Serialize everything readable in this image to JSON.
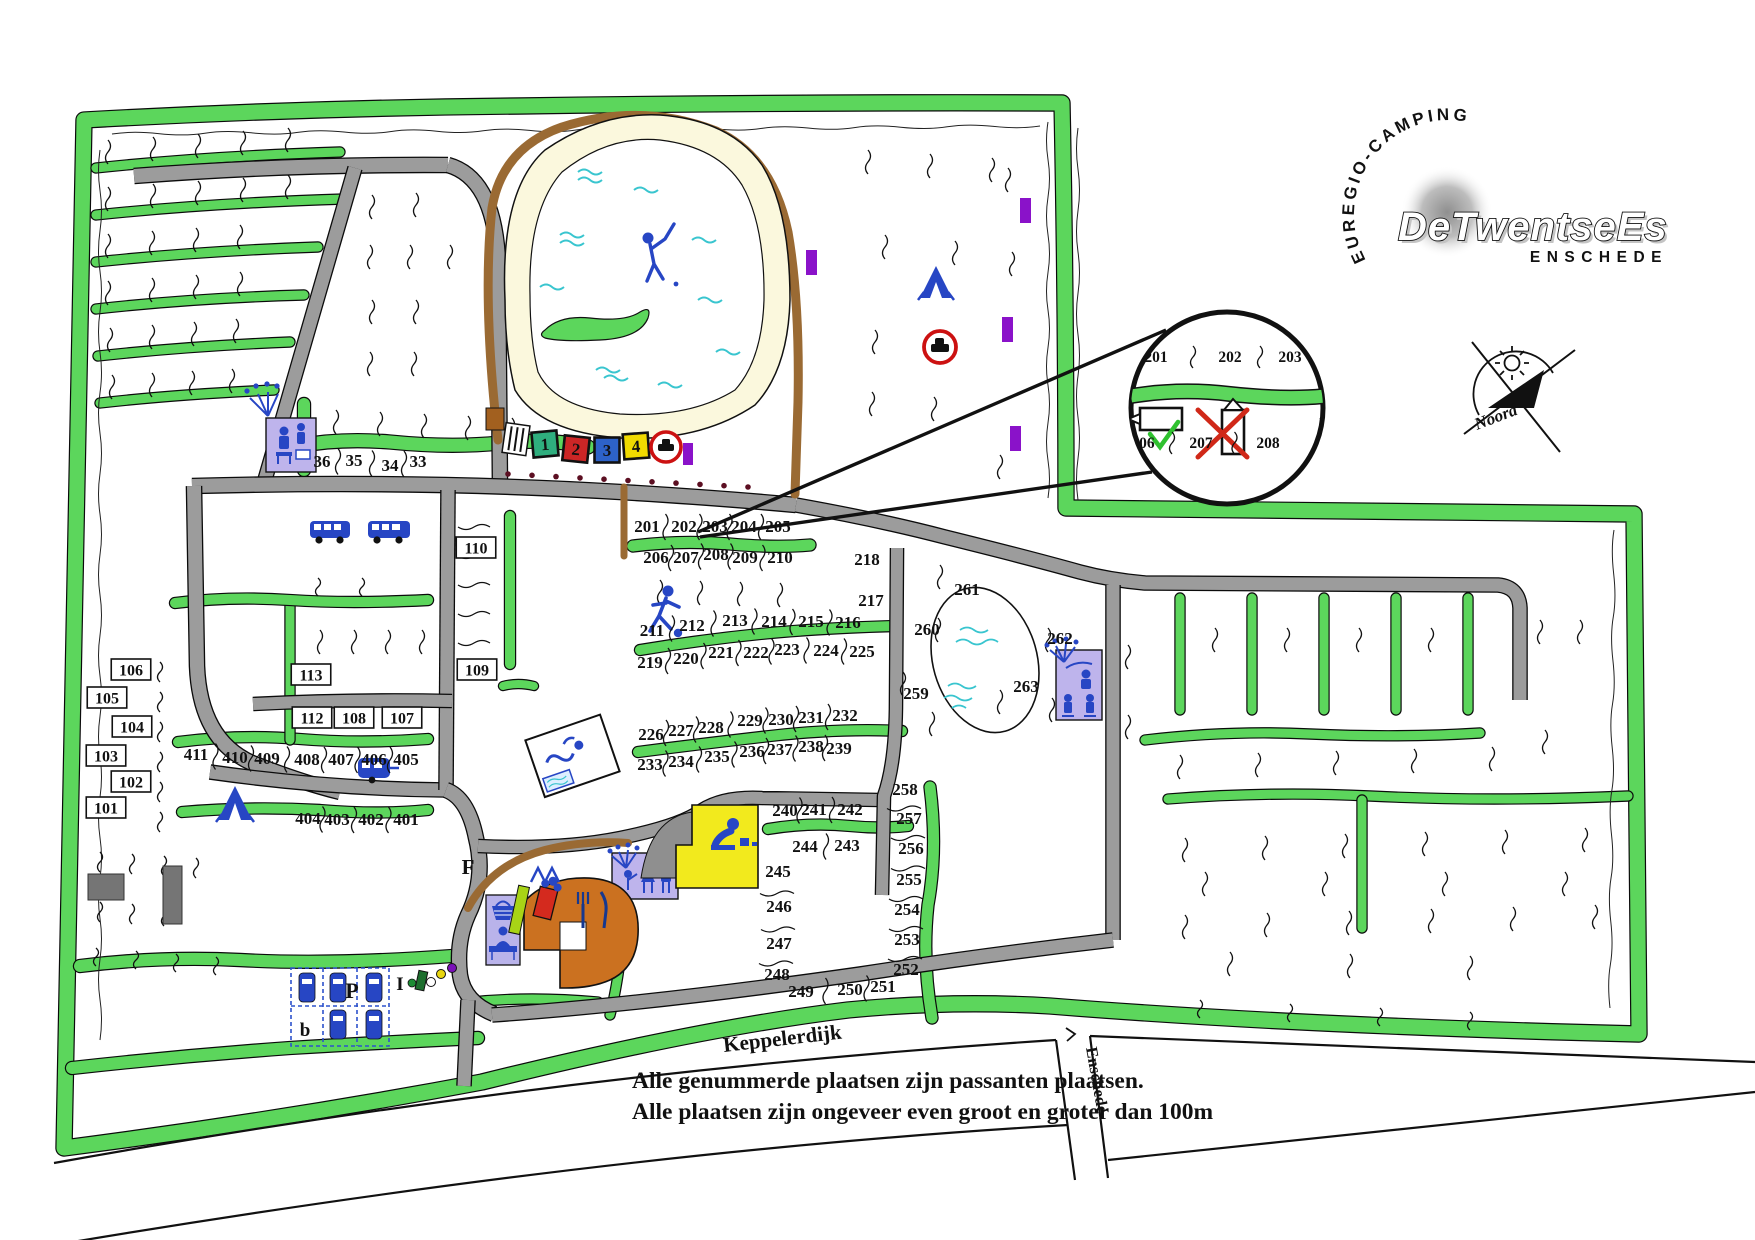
{
  "logo": {
    "curved": "EUREGIO-CAMPING",
    "brand": "DeTwentseEs",
    "city": "ENSCHEDE"
  },
  "compass": {
    "label": "Noord"
  },
  "streets": {
    "main": "Keppelerdijk",
    "direction": "Enschede"
  },
  "notes": {
    "line1": "Alle genummerde plaatsen zijn passanten plaatsen.",
    "line2": "Alle plaatsen zijn ongeveer even groot en groter dan 100m"
  },
  "markers": {
    "reception": "I",
    "parking": "P",
    "parking_small": "b",
    "field": "F"
  },
  "legend_squares": [
    {
      "t": "1",
      "c": "#2fae7e"
    },
    {
      "t": "2",
      "c": "#cc2626"
    },
    {
      "t": "3",
      "c": "#2d62c8"
    },
    {
      "t": "4",
      "c": "#f0da00"
    }
  ],
  "colors": {
    "hedge": "#5cd65c",
    "road": "#9c9c9c",
    "path": "#9a6a33",
    "sand": "#fbf8dd",
    "water": "#39c5cf",
    "icon_blue": "#2746c4",
    "building": "#beb4ec",
    "marker_purple": "#8a12c9",
    "sign_red": "#cc1111",
    "ok_green": "#2fc12f",
    "cross_red": "#d02818"
  },
  "inset": {
    "top": [
      [
        "201",
        1156,
        362
      ],
      [
        "202",
        1230,
        362
      ],
      [
        "203",
        1290,
        362
      ]
    ],
    "bottom": [
      [
        "206",
        1143,
        448
      ],
      [
        "207",
        1201,
        448
      ],
      [
        "208",
        1268,
        448
      ]
    ]
  },
  "plots": {
    "boxed": [
      [
        "101",
        106,
        808
      ],
      [
        "102",
        131,
        782
      ],
      [
        "103",
        106,
        756
      ],
      [
        "104",
        132,
        727
      ],
      [
        "105",
        107,
        698
      ],
      [
        "106",
        131,
        670
      ],
      [
        "113",
        311,
        675
      ],
      [
        "112",
        312,
        718
      ],
      [
        "108",
        354,
        718
      ],
      [
        "107",
        402,
        718
      ],
      [
        "110",
        476,
        548
      ],
      [
        "109",
        477,
        670
      ]
    ],
    "rows": [
      {
        "id": "r36",
        "sep": true,
        "items": [
          [
            "36",
            322,
            462
          ],
          [
            "35",
            354,
            461
          ],
          [
            "34",
            390,
            466
          ],
          [
            "33",
            418,
            462
          ]
        ]
      },
      {
        "id": "r201",
        "sep": true,
        "items": [
          [
            "201",
            647,
            527
          ],
          [
            "202",
            684,
            527
          ],
          [
            "203",
            715,
            527
          ],
          [
            "204",
            744,
            527
          ],
          [
            "205",
            778,
            527
          ]
        ]
      },
      {
        "id": "r206",
        "sep": true,
        "items": [
          [
            "206",
            656,
            558
          ],
          [
            "207",
            686,
            558
          ],
          [
            "208",
            716,
            555
          ],
          [
            "209",
            745,
            558
          ],
          [
            "210",
            780,
            558
          ]
        ]
      },
      {
        "id": "r211",
        "sep": true,
        "items": [
          [
            "211",
            652,
            631
          ],
          [
            "212",
            692,
            626
          ],
          [
            "213",
            735,
            621
          ],
          [
            "214",
            774,
            622
          ],
          [
            "215",
            811,
            622
          ],
          [
            "216",
            848,
            623
          ]
        ]
      },
      {
        "id": "r219",
        "sep": true,
        "items": [
          [
            "219",
            650,
            663
          ],
          [
            "220",
            686,
            659
          ],
          [
            "221",
            721,
            653
          ],
          [
            "222",
            756,
            653
          ],
          [
            "223",
            787,
            650
          ],
          [
            "224",
            826,
            651
          ],
          [
            "225",
            862,
            652
          ]
        ]
      },
      {
        "id": "r226",
        "sep": true,
        "items": [
          [
            "226",
            651,
            735
          ],
          [
            "227",
            681,
            731
          ],
          [
            "228",
            711,
            728
          ],
          [
            "229",
            750,
            721
          ],
          [
            "230",
            781,
            720
          ],
          [
            "231",
            811,
            718
          ],
          [
            "232",
            845,
            716
          ]
        ]
      },
      {
        "id": "r233",
        "sep": true,
        "items": [
          [
            "233",
            650,
            765
          ],
          [
            "234",
            681,
            762
          ],
          [
            "235",
            717,
            757
          ],
          [
            "236",
            752,
            752
          ],
          [
            "237",
            780,
            750
          ],
          [
            "238",
            811,
            747
          ],
          [
            "239",
            839,
            749
          ]
        ]
      },
      {
        "id": "r240",
        "sep": true,
        "items": [
          [
            "240",
            785,
            811
          ],
          [
            "241",
            814,
            810
          ],
          [
            "242",
            850,
            810
          ]
        ]
      },
      {
        "id": "r244",
        "sep": true,
        "items": [
          [
            "244",
            805,
            847
          ],
          [
            "243",
            847,
            846
          ]
        ]
      },
      {
        "id": "r249",
        "sep": true,
        "items": [
          [
            "249",
            801,
            992
          ],
          [
            "250",
            850,
            990
          ],
          [
            "251",
            883,
            987
          ]
        ]
      },
      {
        "id": "r218",
        "sep": false,
        "items": [
          [
            "218",
            867,
            560
          ],
          [
            "217",
            871,
            601
          ]
        ]
      },
      {
        "id": "r411",
        "sep": true,
        "items": [
          [
            "411",
            196,
            755
          ],
          [
            "410",
            235,
            758
          ],
          [
            "409",
            267,
            759
          ],
          [
            "408",
            307,
            760
          ],
          [
            "407",
            341,
            760
          ],
          [
            "406",
            374,
            760
          ],
          [
            "405",
            406,
            760
          ]
        ]
      },
      {
        "id": "r404",
        "sep": true,
        "items": [
          [
            "404",
            308,
            819
          ],
          [
            "403",
            337,
            820
          ],
          [
            "402",
            371,
            820
          ],
          [
            "401",
            406,
            820
          ]
        ]
      },
      {
        "id": "r259",
        "sep": false,
        "items": [
          [
            "259",
            916,
            694
          ],
          [
            "260",
            927,
            630
          ],
          [
            "261",
            967,
            590
          ],
          [
            "262",
            1060,
            639
          ],
          [
            "263",
            1026,
            687
          ]
        ]
      }
    ],
    "columns": [
      {
        "id": "c245",
        "items": [
          [
            "245",
            778,
            872
          ],
          [
            "246",
            779,
            907
          ],
          [
            "247",
            779,
            944
          ],
          [
            "248",
            777,
            975
          ]
        ]
      },
      {
        "id": "c252",
        "items": [
          [
            "252",
            906,
            970
          ],
          [
            "253",
            907,
            940
          ],
          [
            "254",
            907,
            910
          ],
          [
            "255",
            909,
            880
          ],
          [
            "256",
            911,
            849
          ],
          [
            "257",
            909,
            819
          ],
          [
            "258",
            905,
            790
          ]
        ]
      }
    ]
  }
}
